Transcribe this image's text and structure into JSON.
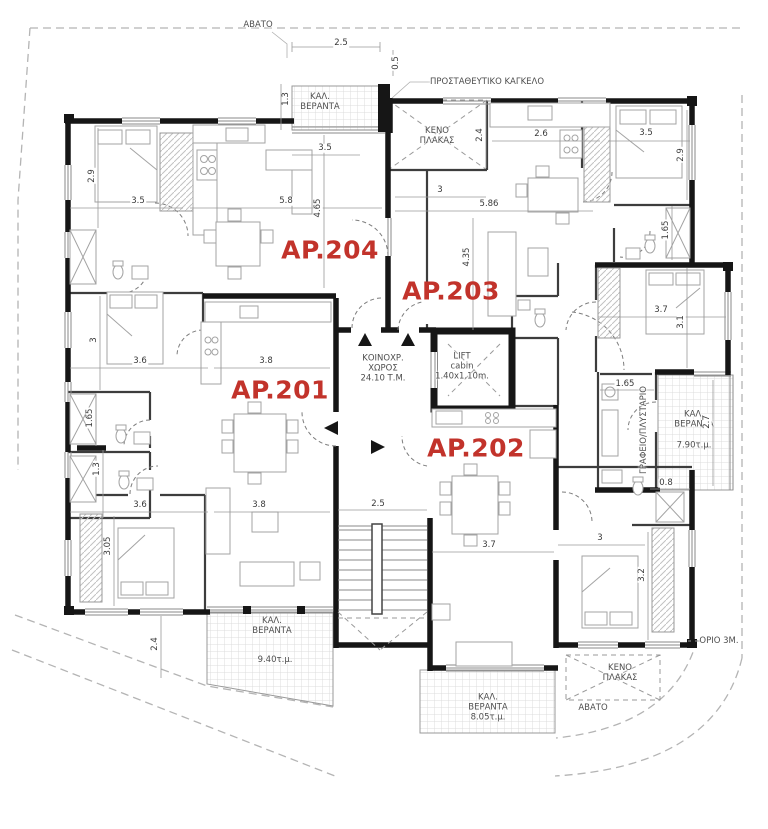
{
  "plan": {
    "colors": {
      "apartment_label": "#c2332b",
      "walls": "#161616",
      "dimension_text": "#3a3a3a",
      "label_text": "#4e4e4e"
    },
    "apartments": [
      {
        "label": "AP.204",
        "x": 330,
        "y": 250
      },
      {
        "label": "AP.203",
        "x": 451,
        "y": 291
      },
      {
        "label": "AP.201",
        "x": 280,
        "y": 390
      },
      {
        "label": "AP.202",
        "x": 476,
        "y": 448
      }
    ],
    "labels": [
      {
        "text": "ΑΒΑΤΟ",
        "x": 258,
        "y": 25
      },
      {
        "text": "ΚΑΛ.\nΒΕΡΑΝΤΑ",
        "x": 320,
        "y": 102
      },
      {
        "text": "ΠΡΟΣΤΑΘΕΥΤΙΚΟ ΚΑΓΚΕΛΟ",
        "x": 487,
        "y": 82
      },
      {
        "text": "ΚΕΝΟ\nΠΛΑΚΑΣ",
        "x": 437,
        "y": 136
      },
      {
        "text": "ΚΟΙΝΟΧΡ.\nΧΩΡΟΣ\n24.10 Τ.Μ.",
        "x": 383,
        "y": 369
      },
      {
        "text": "LIFT\ncabin\n1.40x1.10m.",
        "x": 462,
        "y": 367
      },
      {
        "text": "ΓΡΑΦΕΙΟ/ΠΛΥΣΤΑΡΙΟ",
        "x": 644,
        "y": 430,
        "rot": true
      },
      {
        "text": "ΚΑΛ.\nΒΕΡΑΝΤΑ\n\n7.90τ.μ.",
        "x": 694,
        "y": 430
      },
      {
        "text": "ΚΑΛ.\nΒΕΡΑΝΤΑ",
        "x": 272,
        "y": 626
      },
      {
        "text": "9.40τ.μ.",
        "x": 275,
        "y": 660
      },
      {
        "text": "ΚΑΛ.\nΒΕΡΑΝΤΑ\n8.05τ.μ.",
        "x": 488,
        "y": 708
      },
      {
        "text": "ΚΕΝΟ\nΠΛΑΚΑΣ",
        "x": 620,
        "y": 673
      },
      {
        "text": "ΑΒΑΤΟ",
        "x": 593,
        "y": 708
      },
      {
        "text": "ΟΡΙΟ 3Μ.",
        "x": 719,
        "y": 641
      }
    ],
    "dimensions": [
      {
        "text": "2.5",
        "x": 341,
        "y": 43
      },
      {
        "text": "0.5",
        "x": 396,
        "y": 63,
        "rot": true
      },
      {
        "text": "1.3",
        "x": 286,
        "y": 99,
        "rot": true
      },
      {
        "text": "2.4",
        "x": 480,
        "y": 135,
        "rot": true
      },
      {
        "text": "2.6",
        "x": 541,
        "y": 134
      },
      {
        "text": "3.5",
        "x": 646,
        "y": 133
      },
      {
        "text": "2.9",
        "x": 681,
        "y": 155,
        "rot": true
      },
      {
        "text": "3.5",
        "x": 138,
        "y": 201
      },
      {
        "text": "2.9",
        "x": 92,
        "y": 176,
        "rot": true
      },
      {
        "text": "5.8",
        "x": 286,
        "y": 201
      },
      {
        "text": "4.65",
        "x": 318,
        "y": 208,
        "rot": true
      },
      {
        "text": "3.5",
        "x": 325,
        "y": 148
      },
      {
        "text": "3",
        "x": 440,
        "y": 190
      },
      {
        "text": "5.86",
        "x": 489,
        "y": 204
      },
      {
        "text": "4.35",
        "x": 467,
        "y": 257,
        "rot": true
      },
      {
        "text": "1.65",
        "x": 666,
        "y": 230,
        "rot": true
      },
      {
        "text": "1.65",
        "x": 625,
        "y": 384
      },
      {
        "text": "3.7",
        "x": 661,
        "y": 310
      },
      {
        "text": "3.1",
        "x": 681,
        "y": 322,
        "rot": true
      },
      {
        "text": "3",
        "x": 94,
        "y": 340,
        "rot": true
      },
      {
        "text": "3.6",
        "x": 140,
        "y": 361
      },
      {
        "text": "3.8",
        "x": 266,
        "y": 361
      },
      {
        "text": "1.65",
        "x": 90,
        "y": 418,
        "rot": true
      },
      {
        "text": "1.3",
        "x": 97,
        "y": 469,
        "rot": true
      },
      {
        "text": "3.6",
        "x": 140,
        "y": 505
      },
      {
        "text": "3.05",
        "x": 108,
        "y": 546,
        "rot": true
      },
      {
        "text": "3.8",
        "x": 259,
        "y": 505
      },
      {
        "text": "2.5",
        "x": 378,
        "y": 504
      },
      {
        "text": "3.7",
        "x": 489,
        "y": 545
      },
      {
        "text": "3",
        "x": 600,
        "y": 538
      },
      {
        "text": "3.2",
        "x": 642,
        "y": 575,
        "rot": true
      },
      {
        "text": "0.8",
        "x": 666,
        "y": 483
      },
      {
        "text": "2.7",
        "x": 707,
        "y": 422,
        "rot": true
      },
      {
        "text": "2.4",
        "x": 155,
        "y": 644,
        "rot": true
      }
    ]
  }
}
